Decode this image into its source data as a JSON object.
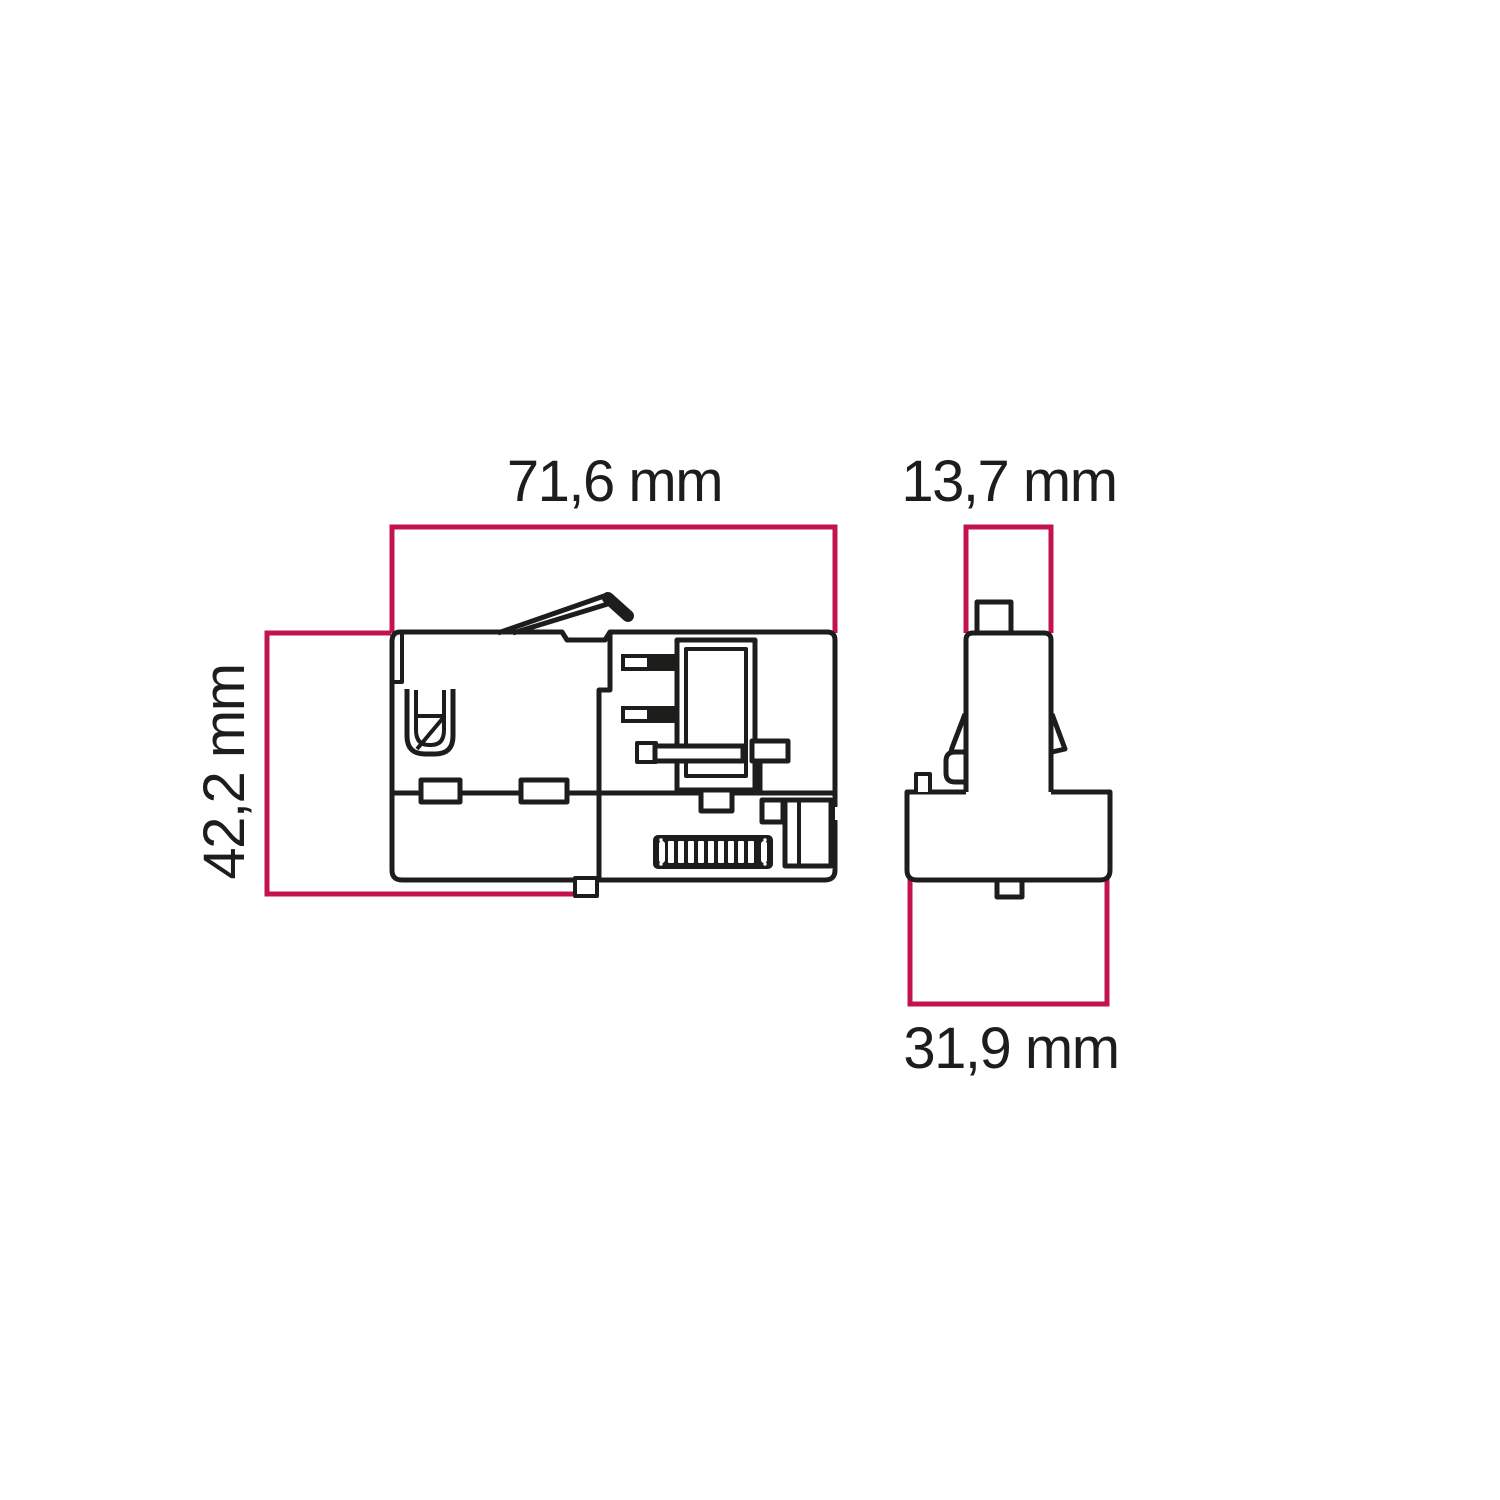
{
  "diagram": {
    "type": "technical-dimension-drawing",
    "subject": "track adapter connector, two orthographic views (side view and end view)",
    "colors": {
      "dimension_line": "#c3134e",
      "outline": "#1d1d1b",
      "background": "#ffffff"
    },
    "dimensions": {
      "side_view_width": "71,6 mm",
      "side_view_height": "42,2 mm",
      "end_view_top_width": "13,7 mm",
      "end_view_base_width": "31,9 mm"
    }
  }
}
